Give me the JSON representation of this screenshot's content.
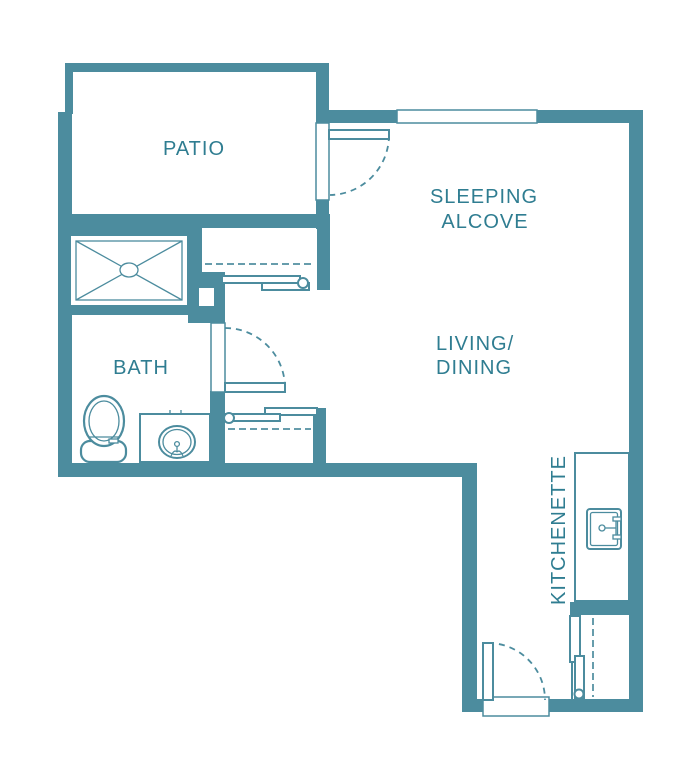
{
  "page": {
    "title": "Studio apartment floor plan"
  },
  "colors": {
    "wall": "#4C8C9E",
    "label": "#2F7D91",
    "background": "#FFFFFF"
  },
  "rooms": {
    "patio": {
      "label": "PATIO"
    },
    "sleeping_alcove": {
      "line1": "SLEEPING",
      "line2": "ALCOVE"
    },
    "living_dining": {
      "line1": "LIVING/",
      "line2": "DINING"
    },
    "bath": {
      "label": "BATH"
    },
    "kitchenette": {
      "label": "KITCHENETTE"
    }
  },
  "features": [
    "shower",
    "toilet",
    "vanity-sink",
    "kitchen-counter",
    "kitchen-sink",
    "closet-sliding-doors",
    "pantry-sliding-doors",
    "swing-door",
    "entry-door",
    "window"
  ]
}
